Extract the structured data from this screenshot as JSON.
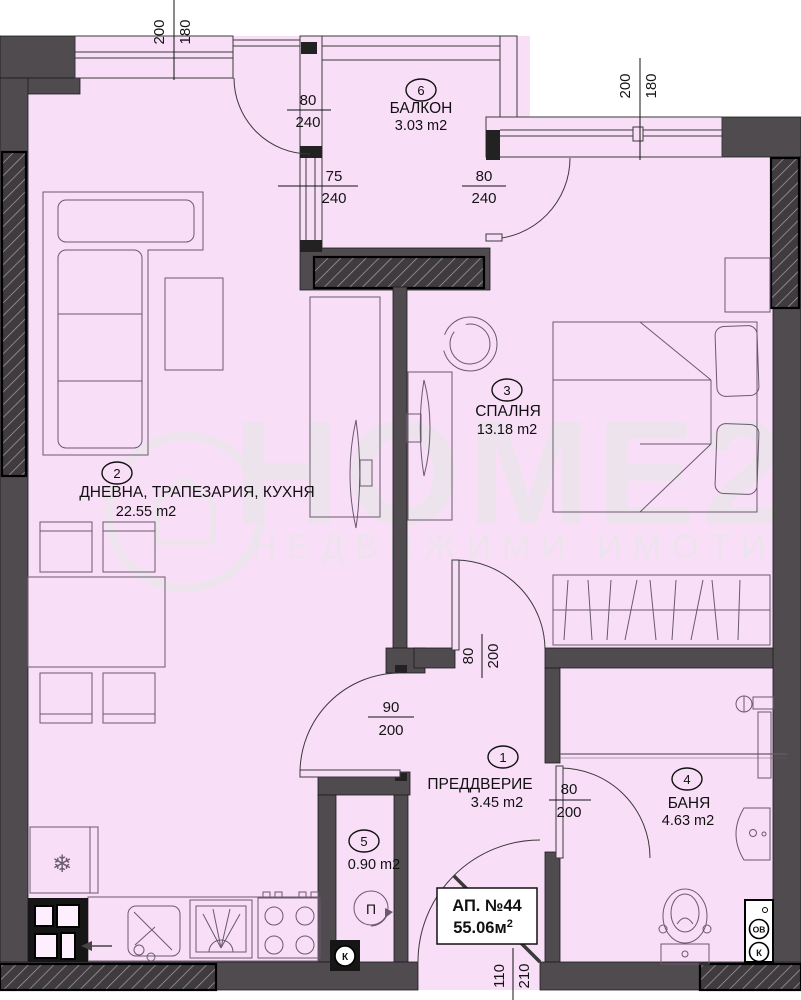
{
  "apartment": {
    "label": "АП. №44",
    "area": "55.06м",
    "area_sup": "2"
  },
  "watermark": {
    "brand": "HOME2U",
    "tagline": "НЕДВИЖИМИ ИМОТИ"
  },
  "rooms": [
    {
      "number": "1",
      "name": "ПРЕДДВЕРИЕ",
      "area": "3.45 m2"
    },
    {
      "number": "2",
      "name": "ДНЕВНА, ТРАПЕЗАРИЯ, КУХНЯ",
      "area": "22.55 m2"
    },
    {
      "number": "3",
      "name": "СПАЛНЯ",
      "area": "13.18 m2"
    },
    {
      "number": "4",
      "name": "БАНЯ",
      "area": "4.63 m2"
    },
    {
      "number": "5",
      "name": "",
      "area": "0.90 m2"
    },
    {
      "number": "6",
      "name": "БАЛКОН",
      "area": "3.03 m2"
    }
  ],
  "dimensions": {
    "living_window": {
      "w": "200",
      "h": "180"
    },
    "bedroom_window": {
      "w": "200",
      "h": "180"
    },
    "living_balcony_door": {
      "w": "80",
      "h": "240"
    },
    "balcony_side_window": {
      "w": "75",
      "h": "240"
    },
    "bedroom_balcony_door": {
      "w": "80",
      "h": "240"
    },
    "living_hall_door": {
      "w": "90",
      "h": "200"
    },
    "bedroom_hall_door": {
      "w": "80",
      "h": "200"
    },
    "bathroom_door": {
      "w": "80",
      "h": "200"
    },
    "entrance_door": {
      "w": "110",
      "h": "210"
    }
  },
  "legend": {
    "k": "К",
    "ov": "ОВ",
    "p": "П"
  },
  "icons": {
    "snowflake": "❄"
  }
}
